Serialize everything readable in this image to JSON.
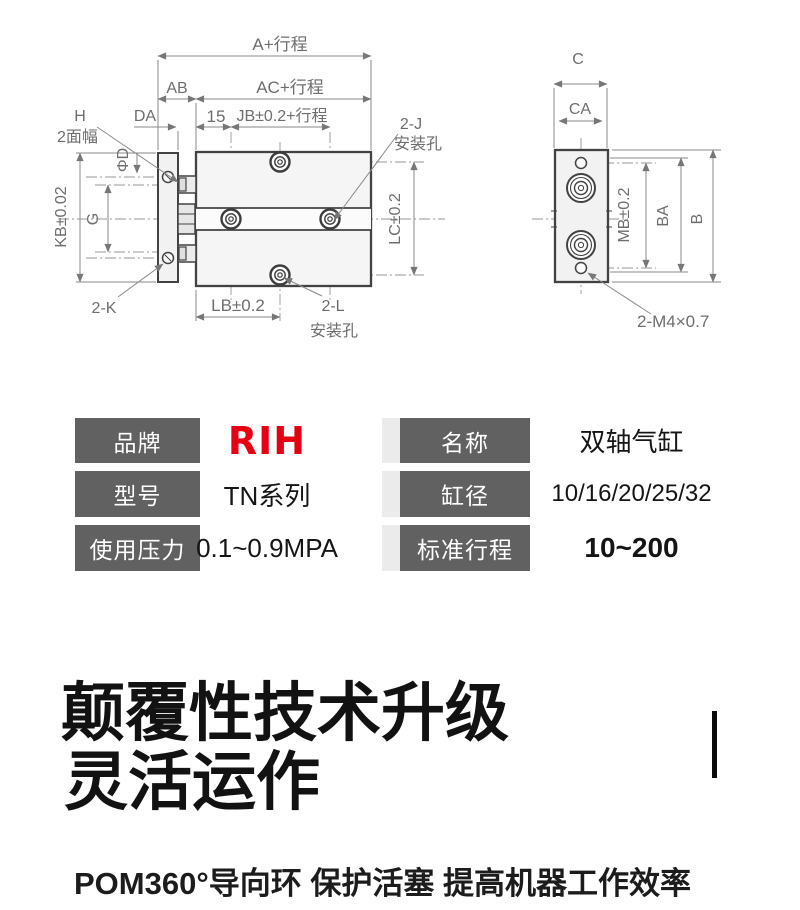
{
  "diagram": {
    "a": "A+行程",
    "ab": "AB",
    "ac": "AC+行程",
    "da": "DA",
    "fifteen": "15",
    "jb": "JB±0.2+行程",
    "h": "H",
    "two_face": "2面幅",
    "phi_d": "ΦD",
    "kb": "KB±0.02",
    "g": "G",
    "two_k": "2-K",
    "lb": "LB±0.2",
    "two_l": "2-L",
    "hole_bottom": "安装孔",
    "two_j": "2-J",
    "hole_top": "安装孔",
    "lc": "LC±0.2",
    "c": "C",
    "ca": "CA",
    "mb": "MB±0.2",
    "ba": "BA",
    "b": "B",
    "m4": "2-M4×0.7"
  },
  "spec_table": {
    "header_bg": "#616161",
    "brand_color": "#e60012",
    "rows": [
      {
        "label_left": "品牌",
        "value_left": "RIH",
        "label_right": "名称",
        "value_right": "双轴气缸"
      },
      {
        "label_left": "型号",
        "value_left": "TN系列",
        "label_right": "缸径",
        "value_right": "10/16/20/25/32"
      },
      {
        "label_left": "使用压力",
        "value_left": "0.1~0.9MPA",
        "label_right": "标准行程",
        "value_right": "10~200"
      }
    ]
  },
  "promo": {
    "headline_line1": "颠覆性技术升级",
    "headline_line2": "灵活运作",
    "subline": "POM360°导向环 保护活塞 提高机器工作效率"
  }
}
